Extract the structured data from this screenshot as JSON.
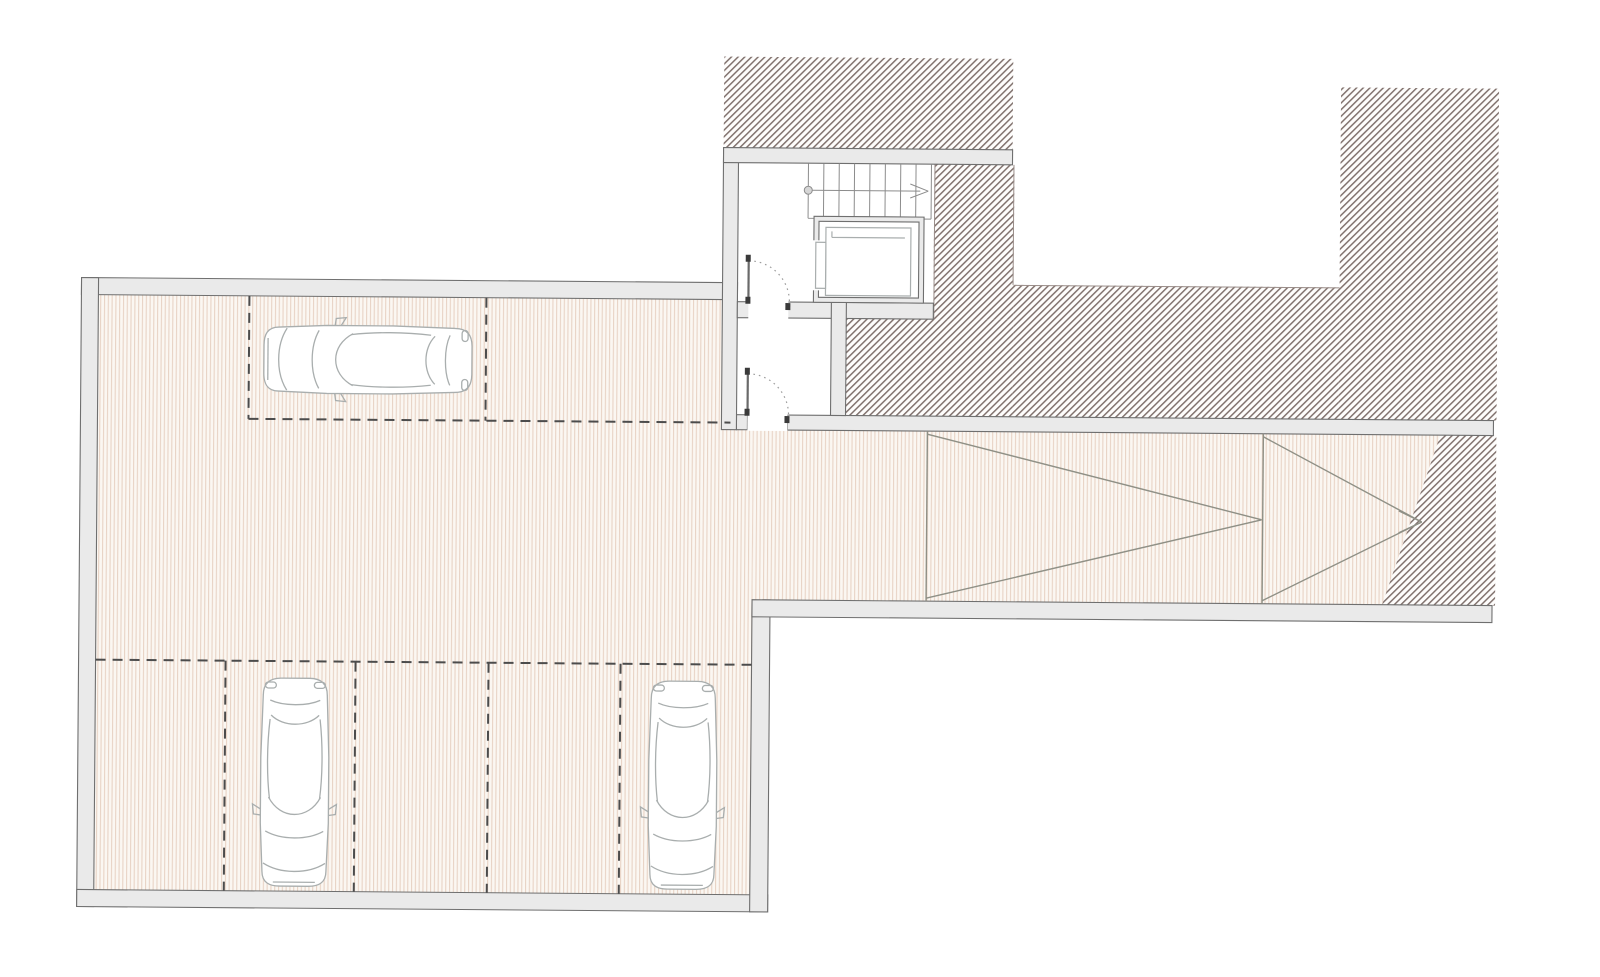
{
  "meta": {
    "kind": "architectural floor plan",
    "content": "underground parking garage level with stair core, elevator, vestibule doors, ramp with direction chevrons, three parked cars, hatched earth poche",
    "visible_text": ""
  },
  "colors": {
    "page_bg": "#ffffff",
    "wall_fill": "#eaeaea",
    "wall_line": "#6f6f6f",
    "floor_base": "#fbf7f2",
    "floor_stripe": "#e8d3c5",
    "hatch_bg": "#fefdfc",
    "hatch_line": "#81726e",
    "dash_line": "#4c4c4c",
    "car_line": "#a9aeae",
    "car_fill": "#ffffff",
    "ramp_line": "#8f9086",
    "stair_line": "#8c8c8c",
    "door_leaf": "#6a6a6a",
    "door_arc": "#9c9c9c",
    "jamb_tick": "#3a3a3a",
    "edge_line": "#9a8d89",
    "opening_fill": "#ffffff"
  },
  "inventory": {
    "cars": 3,
    "stair_treads": 8,
    "elevators": 1,
    "doors": 2,
    "parking_dividers_top_row": 2,
    "parking_dividers_bottom_row": 4,
    "ramp_chevrons": 2
  }
}
